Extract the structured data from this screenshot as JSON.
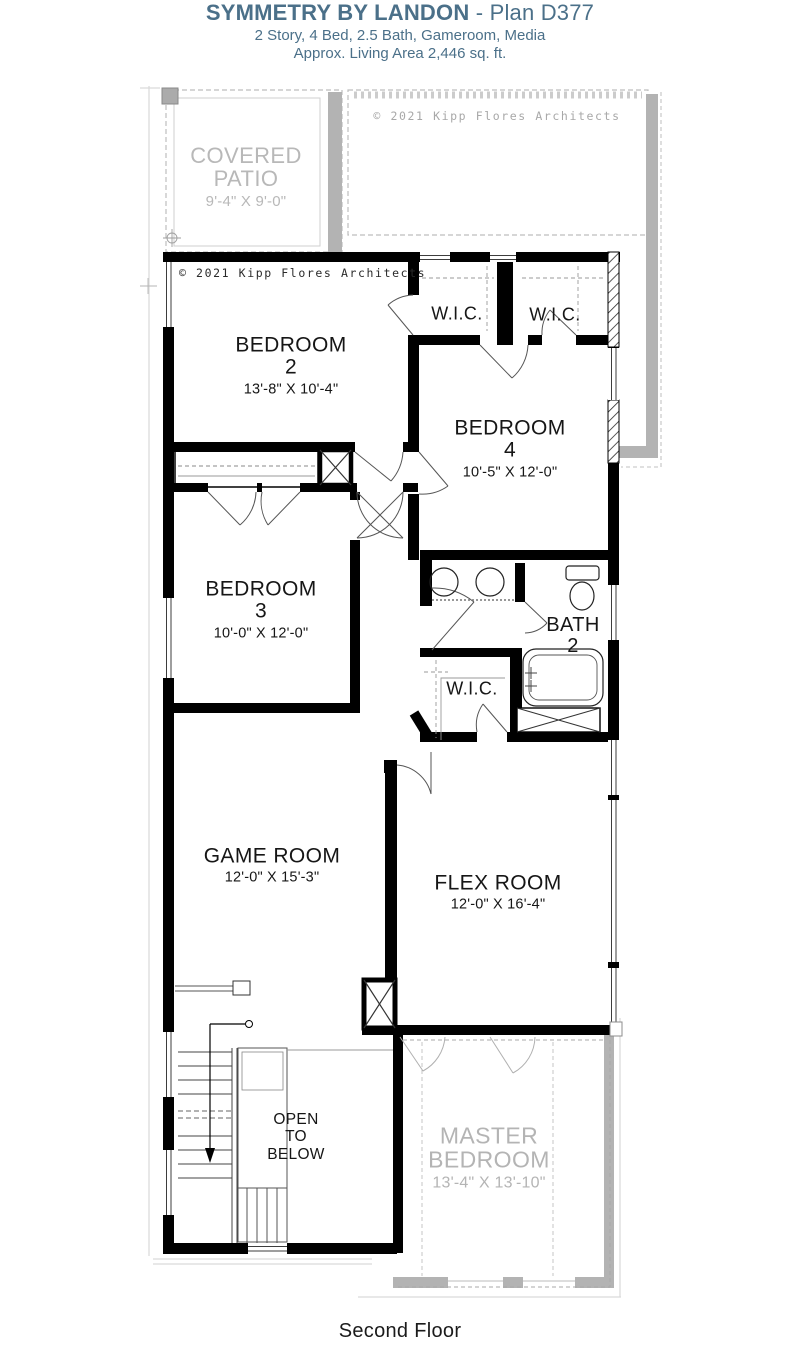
{
  "header": {
    "title_bold": "SYMMETRY BY LANDON",
    "title_rest": " - Plan D377",
    "subtitle1": "2 Story, 4 Bed, 2.5 Bath, Gameroom, Media",
    "subtitle2": "Approx. Living Area 2,446 sq. ft."
  },
  "colors": {
    "title_blue": "#4b7089",
    "wall_black": "#000000",
    "plan_gray": "#b3b3b3",
    "faded_text_gray": "#b4b4b4",
    "copyright_gray": "#a8a8a8"
  },
  "copyright": {
    "top": "© 2021 Kipp Flores Architects",
    "inner": "© 2021 Kipp Flores Architects"
  },
  "rooms": {
    "covered_patio": {
      "name_line1": "COVERED",
      "name_line2": "PATIO",
      "dims": "9'-4\" X 9'-0\""
    },
    "bedroom2": {
      "name": "BEDROOM",
      "number": "2",
      "dims": "13'-8\" X 10'-4\""
    },
    "bedroom4": {
      "name": "BEDROOM",
      "number": "4",
      "dims": "10'-5\" X 12'-0\""
    },
    "bedroom3": {
      "name": "BEDROOM",
      "number": "3",
      "dims": "10'-0\" X 12'-0\""
    },
    "wic1": {
      "name": "W.I.C."
    },
    "wic2": {
      "name": "W.I.C."
    },
    "wic3": {
      "name": "W.I.C."
    },
    "bath2": {
      "name_line1": "BATH",
      "name_line2": "2"
    },
    "game_room": {
      "name": "GAME ROOM",
      "dims": "12'-0\" X 15'-3\""
    },
    "flex_room": {
      "name": "FLEX ROOM",
      "dims": "12'-0\" X 16'-4\""
    },
    "open_to_below": {
      "line1": "OPEN",
      "line2": "TO",
      "line3": "BELOW"
    },
    "master_bedroom": {
      "name_line1": "MASTER",
      "name_line2": "BEDROOM",
      "dims": "13'-4\" X 13'-10\""
    }
  },
  "footer": {
    "floor_label": "Second Floor"
  }
}
